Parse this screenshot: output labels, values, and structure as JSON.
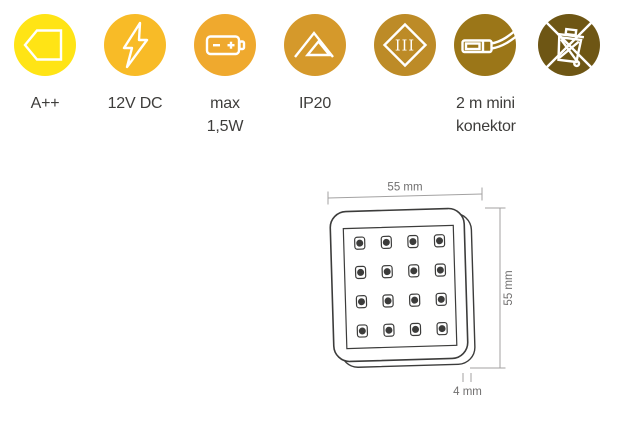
{
  "features": [
    {
      "name": "energy-class",
      "icon": "energy-label-arrow-icon",
      "color": "#FFE415",
      "label_line1": "A++",
      "label_line2": ""
    },
    {
      "name": "voltage",
      "icon": "lightning-bolt-icon",
      "color": "#F8BB27",
      "label_line1": "12V DC",
      "label_line2": ""
    },
    {
      "name": "max-power",
      "icon": "battery-icon",
      "color": "#EFA92E",
      "label_line1": "max",
      "label_line2": "1,5W"
    },
    {
      "name": "ip-rating",
      "icon": "double-triangle-icon",
      "color": "#D5992B",
      "label_line1": "IP20",
      "label_line2": ""
    },
    {
      "name": "protection-class",
      "icon": "class-iii-diamond-icon",
      "color": "#BD8B27",
      "label_line1": "",
      "label_line2": "",
      "icon_text": "III"
    },
    {
      "name": "cable",
      "icon": "mini-connector-icon",
      "color": "#9B7618",
      "label_line1": "2 m mini",
      "label_line2": "konektor"
    },
    {
      "name": "weee-disposal",
      "icon": "crossed-out-bin-icon",
      "color": "#6E5614",
      "label_line1": "",
      "label_line2": ""
    }
  ],
  "diagram": {
    "width_label": "55 mm",
    "height_label": "55 mm",
    "depth_label": "4 mm",
    "led_rows": 4,
    "led_cols": 4
  }
}
